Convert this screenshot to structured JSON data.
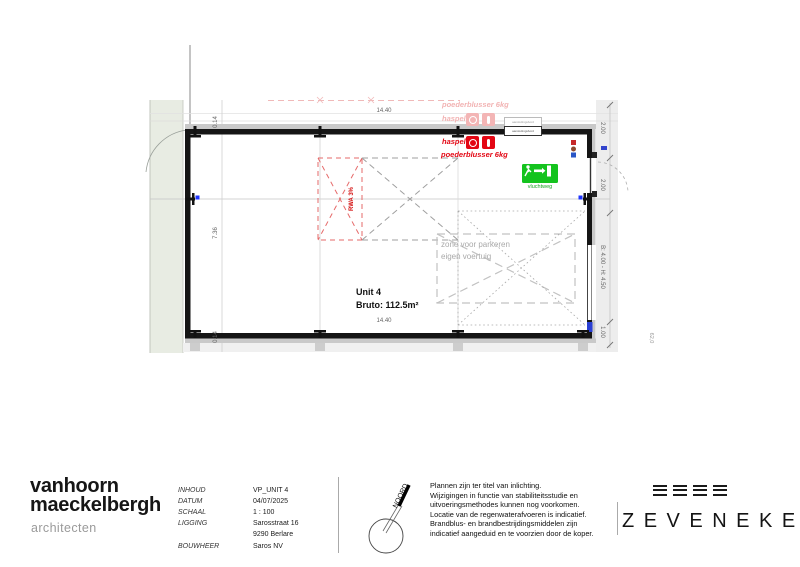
{
  "plan": {
    "dimensions": {
      "top_width": "14.40",
      "bottom_width": "14.40",
      "interior_height": "7.36",
      "wall_thickness_top": "0.14",
      "wall_thickness_bottom": "0.14",
      "right_segment_top": "2.00",
      "right_door_width": "2.00",
      "right_gate": "B: 4.00 - H: 4.50",
      "right_segment_bottom": "1.00",
      "site_level": "62,0"
    },
    "unit": {
      "name": "Unit 4",
      "area": "Bruto: 112.5m²"
    },
    "annotations": {
      "rwa": "RWA 3%",
      "parking_line1": "zone voor parkeren",
      "parking_line2": "eigen voertuig",
      "exit_sign": "vluchtweg",
      "hose_reel": "haspel",
      "extinguisher": "poederblusser 6kg",
      "hose_reel_faded": "haspel",
      "extinguisher_faded": "poederblusser 6kg",
      "connection_box_1": "aansluitingsbord",
      "connection_box_2": "aansluitingsbord"
    },
    "colors": {
      "fire_red": "#e30613",
      "faded_pink": "#f2b3b3",
      "exit_green": "#14c31e",
      "terrain_green": "#e8ece3"
    }
  },
  "footer": {
    "architect": {
      "name_line1": "vanhoorn",
      "name_line2": "maeckelbergh",
      "subtitle": "architecten"
    },
    "project": {
      "rows": [
        {
          "label": "INHOUD",
          "value": "VP_UNIT 4"
        },
        {
          "label": "DATUM",
          "value": "04/07/2025"
        },
        {
          "label": "SCHAAL",
          "value": "1 : 100"
        },
        {
          "label": "LIGGING",
          "value": "Sarosstraat 16"
        },
        {
          "label": "",
          "value": "9290 Berlare"
        },
        {
          "label": "BOUWHEER",
          "value": "Saros NV"
        }
      ]
    },
    "north_label": "NOORD",
    "disclaimer": [
      "Plannen zijn ter titel van inlichting.",
      "Wijzigingen in functie van stabiliteitsstudie en",
      "uitvoeringsmethodes kunnen nog voorkomen.",
      "Locatie van de regenwaterafvoeren is indicatief.",
      "Brandblus- en brandbestrijdingsmiddelen zijn",
      "indicatief aangeduid en te voorzien door de koper."
    ],
    "brand": {
      "name": "ZEVENEKE"
    }
  }
}
